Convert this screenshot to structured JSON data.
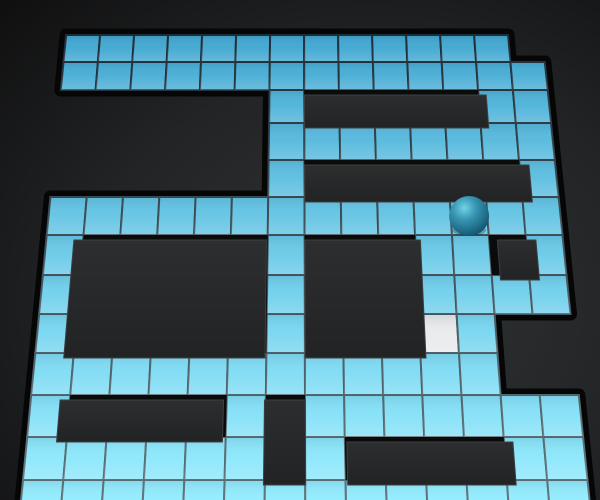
{
  "scene": {
    "kind": "3d-tile-maze",
    "viewport": {
      "width": 600,
      "height": 500
    }
  },
  "grid": {
    "cols": 14,
    "rows": 13,
    "legend": {
      ".": "floor-tile",
      "#": "empty-gap",
      "W": "wall-base",
      "S": "target-tile"
    },
    "cells": [
      ".............#",
      "..............",
      "######.WWWWW..",
      "######........",
      "######.WWWWWW.",
      "..............",
      ".WWWWW.WWW..W.",
      ".WWWWW.WWW....",
      ".WWWWW.WWWS.##",
      "............##",
      ".WWWW.W.......",
      "......W.WWWW..",
      ".............."
    ]
  },
  "walls": [
    {
      "r": 2,
      "c": 7,
      "w": 5,
      "h": 1
    },
    {
      "r": 4,
      "c": 7,
      "w": 6,
      "h": 1
    },
    {
      "r": 6,
      "c": 1,
      "w": 5,
      "h": 3
    },
    {
      "r": 6,
      "c": 7,
      "w": 3,
      "h": 3
    },
    {
      "r": 6,
      "c": 12,
      "w": 1,
      "h": 1
    },
    {
      "r": 10,
      "c": 1,
      "w": 4,
      "h": 1
    },
    {
      "r": 10,
      "c": 6,
      "w": 1,
      "h": 2
    },
    {
      "r": 11,
      "c": 8,
      "w": 4,
      "h": 1
    }
  ],
  "ball": {
    "row": 5,
    "col": 11,
    "radius": 20
  },
  "target_tile": {
    "row": 8,
    "col": 10
  },
  "geometry": {
    "center_x": 298,
    "ref_left": 50,
    "tile_w": 36.36,
    "row_ys": [
      35,
      62,
      90,
      123,
      160,
      197,
      235,
      275,
      314,
      353,
      395,
      437,
      480,
      525
    ],
    "scale_base": 0.94,
    "scale_ref_y": 48,
    "scale_slope": 0.000391,
    "rim_width": 13,
    "grout_width": 2,
    "wall_dx_factor": 0.045,
    "wall_dy": 5
  },
  "colors": {
    "bg_center": "#303334",
    "bg_mid": "#222425",
    "bg_edge": "#101011",
    "rim": "#060607",
    "tile_far": "#41a7d1",
    "tile_near": "#93edff",
    "grout_far": "#1f2e36",
    "grout_near": "#5f737b",
    "target_tile": "#e9eaec",
    "wall_side": "#0a0b0b",
    "wall_top": "#2d2e2f",
    "wall_top_deep": "#222324",
    "wall_edge": "#3d4042",
    "ball_highlight": "#72d2e4",
    "ball_mid": "#3795b3",
    "ball_dark": "#1d6784",
    "ball_limb": "#134a61",
    "ball_shadow": "rgba(8,40,58,0.30)",
    "shade_top": "rgba(0,25,50,0.10)",
    "shade_mid": "rgba(255,255,255,0.03)",
    "shine_bottom": "rgba(255,255,255,0.20)"
  }
}
